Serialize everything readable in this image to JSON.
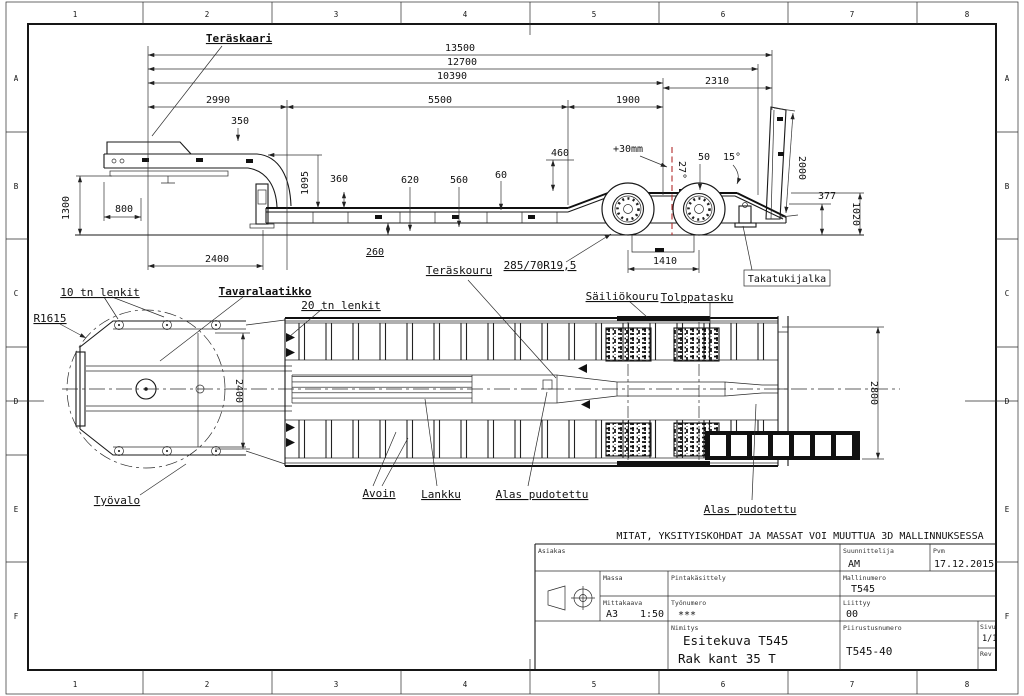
{
  "frame": {
    "cols": [
      "1",
      "2",
      "3",
      "4",
      "5",
      "6",
      "7",
      "8"
    ],
    "rows": [
      "A",
      "B",
      "C",
      "D",
      "E",
      "F"
    ]
  },
  "side": {
    "teraskaari": "Teräskaari",
    "d13500": "13500",
    "d12700": "12700",
    "d10390": "10390",
    "d2310": "2310",
    "d2990": "2990",
    "d5500": "5500",
    "d1900": "1900",
    "d350": "350",
    "d1300": "1300",
    "d800": "800",
    "d2400": "2400",
    "d1095": "1095",
    "d360": "360",
    "d620": "620",
    "d560": "560",
    "d60": "60",
    "d260": "260",
    "d460": "460",
    "plus30": "+30mm",
    "a27": "27°",
    "d50": "50",
    "a15": "15°",
    "d2000": "2000",
    "d377": "377",
    "d1020": "1020",
    "d1410": "1410",
    "tire": "285/70R19,5",
    "teraskouru": "Teräskouru",
    "takatukijalka": "Takatukijalka"
  },
  "plan": {
    "lenkit10": "10 tn lenkit",
    "tavaralaatikko": "Tavaralaatikko",
    "lenkit20": "20 tn lenkit",
    "r1615": "R1615",
    "sailiokouru": "Säiliökouru",
    "tolppatasku": "Tolppatasku",
    "tyovalo": "Työvalo",
    "avoin": "Avoin",
    "lankku": "Lankku",
    "alas1": "Alas pudotettu",
    "alas2": "Alas pudotettu",
    "d2400": "2400",
    "d2800": "2800"
  },
  "note": "MITAT, YKSITYISKOHDAT JA MASSAT VOI MUUTTUA 3D MALLINNUKSESSA",
  "tb": {
    "asiakas_l": "Asiakas",
    "suunnittelija_l": "Suunnittelija",
    "suunnittelija": "AM",
    "pvm_l": "Pvm",
    "pvm": "17.12.2015",
    "massa_l": "Massa",
    "pinta_l": "Pintakäsittely",
    "malli_l": "Mallinumero",
    "malli": "T545",
    "mitta_l": "Mittakaava",
    "arkki": "A3",
    "skaala": "1:50",
    "tyonro_l": "Työnumero",
    "tyonro": "***",
    "liittyy_l": "Liittyy",
    "liittyy": "00",
    "nimitys_l": "Nimitys",
    "nimitys1": "Esitekuva T545",
    "nimitys2": "Rak kant 35 T",
    "piirnro_l": "Piirustusnumero",
    "piirnro": "T545-40",
    "sivu_l": "Sivu",
    "sivu": "1/1",
    "rev_l": "Rev"
  },
  "colors": {
    "line": "#191919",
    "red_dash": "#b02a2a",
    "paper": "#ffffff"
  }
}
